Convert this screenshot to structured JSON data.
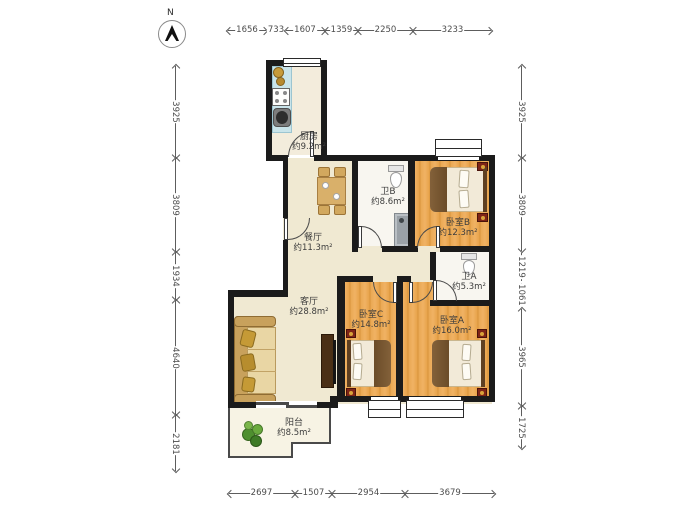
{
  "north": {
    "label": "N"
  },
  "rooms": {
    "kitchen": {
      "name": "厨房",
      "area": "约9.2m²"
    },
    "dining": {
      "name": "餐厅",
      "area": "约11.3m²"
    },
    "bath_b": {
      "name": "卫B",
      "area": "约8.6m²"
    },
    "bedroom_b": {
      "name": "卧室B",
      "area": "约12.3m²"
    },
    "bath_a": {
      "name": "卫A",
      "area": "约5.3m²"
    },
    "living": {
      "name": "客厅",
      "area": "约28.8m²"
    },
    "bedroom_c": {
      "name": "卧室C",
      "area": "约14.8m²"
    },
    "bedroom_a": {
      "name": "卧室A",
      "area": "约16.0m²"
    },
    "balcony": {
      "name": "阳台",
      "area": "约8.5m²"
    }
  },
  "dims": {
    "top": [
      "1656",
      "733",
      "1607",
      "1359",
      "2250",
      "3233"
    ],
    "bottom": [
      "2697",
      "1507",
      "2954",
      "3679"
    ],
    "left": [
      "3925",
      "3809",
      "1934",
      "4640",
      "2181"
    ],
    "right": [
      "3925",
      "3809",
      "1219",
      "1061",
      "3965",
      "1725"
    ]
  },
  "colors": {
    "wall": "#1b1b1b",
    "wood_floor": "#e8a44c",
    "tile_floor": "#f0e9d2",
    "bath_floor": "#f8f6f0",
    "counter": "#c9e4ea",
    "bed_blanket": "#7b5a35",
    "nightstand": "#7e2417",
    "plant": "#4e8f2f"
  }
}
